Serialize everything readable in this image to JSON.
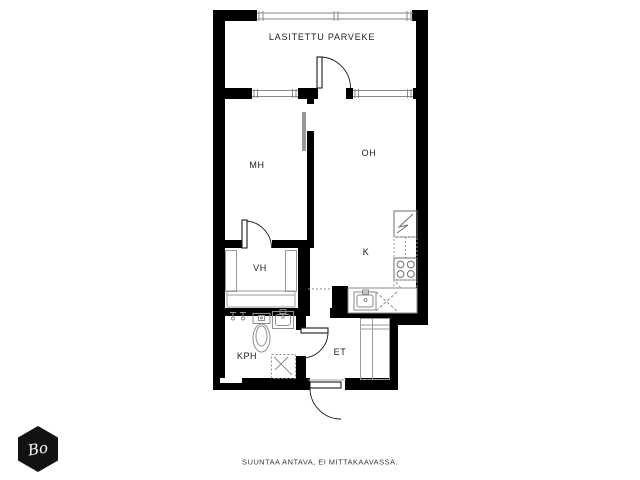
{
  "plan": {
    "title": "apartment-floor-plan",
    "rooms": [
      {
        "id": "parveke",
        "label": "LASITETTU PARVEKE"
      },
      {
        "id": "mh",
        "label": "MH"
      },
      {
        "id": "oh",
        "label": "OH"
      },
      {
        "id": "k",
        "label": "K"
      },
      {
        "id": "vh",
        "label": "VH"
      },
      {
        "id": "kph",
        "label": "KPH"
      },
      {
        "id": "et",
        "label": "ET"
      }
    ],
    "fixtures": [
      "balcony-glazing",
      "balcony-door",
      "window",
      "sliding-door",
      "wardrobe",
      "refrigerator",
      "upper-cabinet",
      "stove",
      "kitchen-counter",
      "kitchen-sink",
      "washing-machine-taps",
      "toilet",
      "washbasin",
      "shower",
      "entry-closet",
      "entrance-door"
    ],
    "footer": {
      "disclaimer": "SUUNTAA ANTAVA, EI MITTAKAAVASSA."
    },
    "logo": {
      "text": "Bo"
    },
    "colors": {
      "wall": "#000000",
      "background": "#ffffff",
      "fixture_line": "#999999",
      "appliance_line": "#666666",
      "label_text": "#1c1c1c",
      "footer_text": "#3a3a3a",
      "logo_bg": "#121212",
      "logo_text": "#ffffff"
    }
  }
}
